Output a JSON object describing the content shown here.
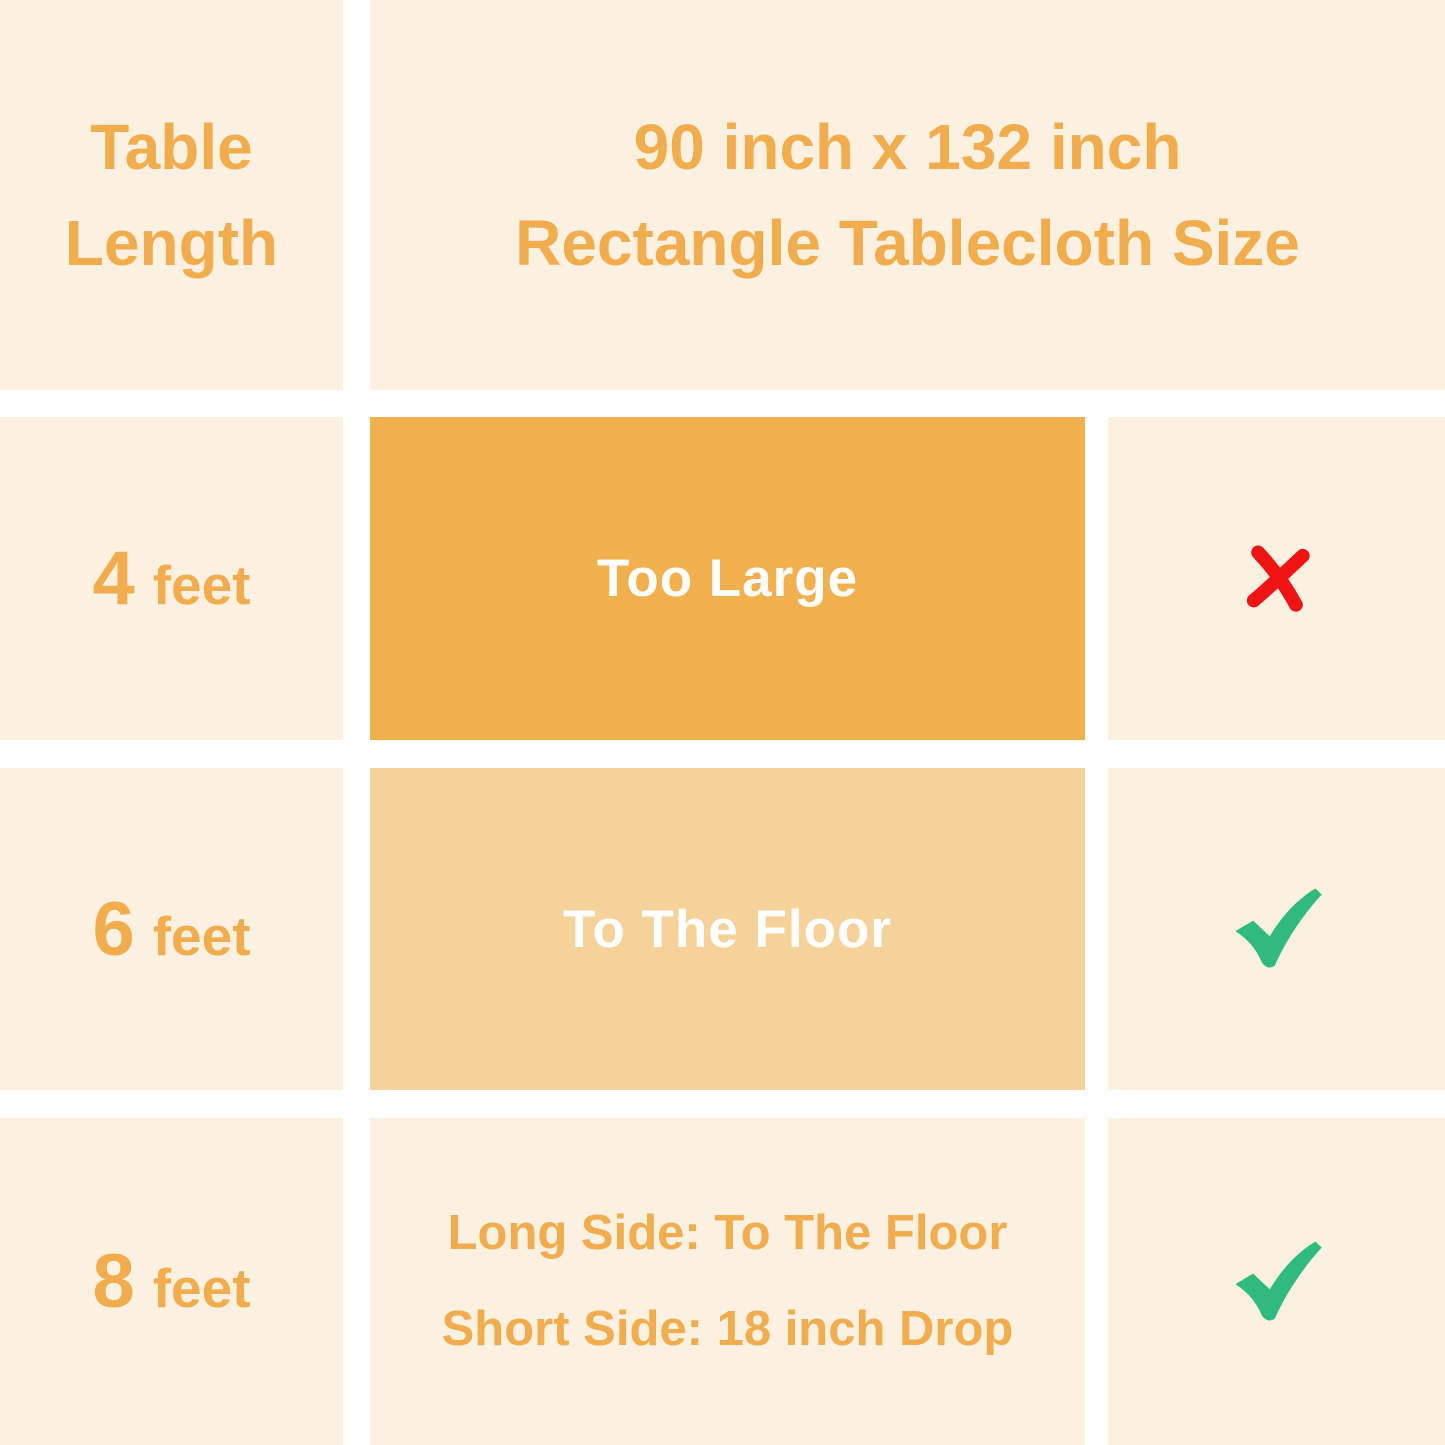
{
  "header": {
    "col1_line1": "Table",
    "col1_line2": "Length",
    "title_line1": "90 inch x 132 inch",
    "title_line2": "Rectangle Tablecloth Size"
  },
  "rows": [
    {
      "length_value": "4",
      "length_unit": "feet",
      "fit_text": "Too Large",
      "verdict": "not-suitable",
      "verdict_icon": "cross-icon"
    },
    {
      "length_value": "6",
      "length_unit": "feet",
      "fit_text": "To The Floor",
      "verdict": "suitable",
      "verdict_icon": "check-icon"
    },
    {
      "length_value": "8",
      "length_unit": "feet",
      "fit_line1": "Long Side: To The Floor",
      "fit_line2": "Short Side: 18 inch Drop",
      "verdict": "suitable",
      "verdict_icon": "check-icon"
    }
  ],
  "colors": {
    "grid_gap_white": "#FFFFFF",
    "cell_cream": "#FCF1E1",
    "box_dark_orange": "#F1B04E",
    "box_light_orange": "#F6D29B",
    "text_orange": "#F0AC4D",
    "text_white": "#FFFFFF",
    "cross_red": "#EE1414",
    "check_green": "#30BA7E"
  },
  "chart_data": {
    "type": "table",
    "title": "90 inch x 132 inch Rectangle Tablecloth Size",
    "columns": [
      "Table Length",
      "90 inch x 132 inch Rectangle Tablecloth Size",
      "Suitability"
    ],
    "rows": [
      {
        "table_length": "4 feet",
        "fit": "Too Large",
        "suitable": false
      },
      {
        "table_length": "6 feet",
        "fit": "To The Floor",
        "suitable": true
      },
      {
        "table_length": "8 feet",
        "fit": "Long Side: To The Floor; Short Side: 18 inch Drop",
        "suitable": true
      }
    ]
  }
}
